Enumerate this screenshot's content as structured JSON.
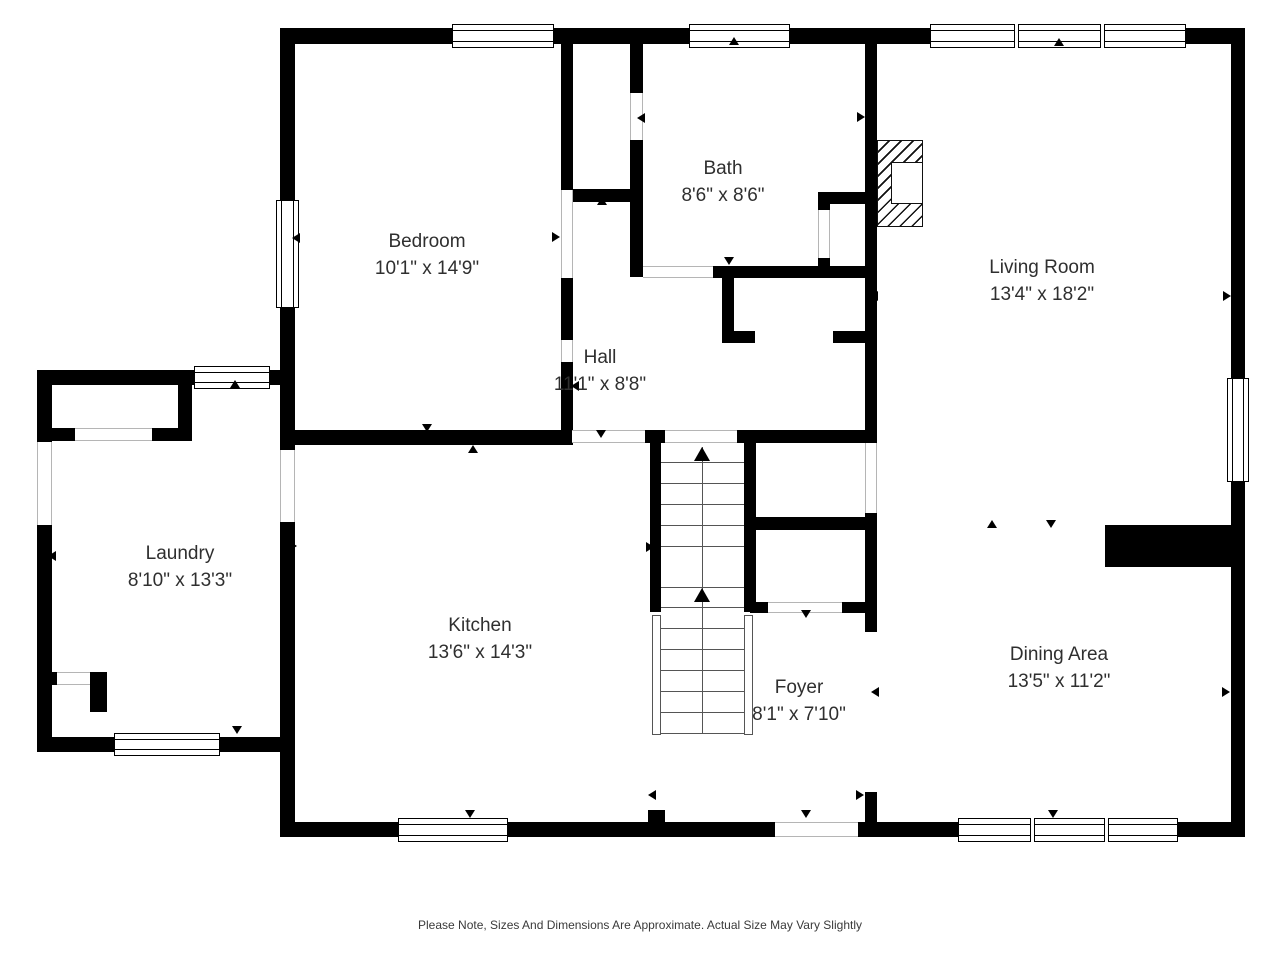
{
  "footer": {
    "note": "Please Note, Sizes And Dimensions Are Approximate. Actual Size May Vary Slightly"
  },
  "colors": {
    "wall": "#000000",
    "background": "#ffffff",
    "label_text": "#2f2f2f",
    "threshold_line": "#b5b5b5",
    "stair_line": "#555555"
  },
  "rooms": [
    {
      "name": "Bedroom",
      "dims": "10'1\" x 14'9\"",
      "cx": 427,
      "cy": 255
    },
    {
      "name": "Bath",
      "dims": "8'6\" x 8'6\"",
      "cx": 723,
      "cy": 182
    },
    {
      "name": "Living Room",
      "dims": "13'4\" x 18'2\"",
      "cx": 1042,
      "cy": 281
    },
    {
      "name": "Hall",
      "dims": "11'1\" x 8'8\"",
      "cx": 600,
      "cy": 371
    },
    {
      "name": "Laundry",
      "dims": "8'10\" x 13'3\"",
      "cx": 180,
      "cy": 567
    },
    {
      "name": "Kitchen",
      "dims": "13'6\" x 14'3\"",
      "cx": 480,
      "cy": 639
    },
    {
      "name": "Foyer",
      "dims": "8'1\" x 7'10\"",
      "cx": 799,
      "cy": 701
    },
    {
      "name": "Dining Area",
      "dims": "13'5\" x 11'2\"",
      "cx": 1059,
      "cy": 668
    }
  ],
  "geometry": {
    "walls": [
      [
        280,
        28,
        965,
        16
      ],
      [
        1231,
        28,
        14,
        350
      ],
      [
        1231,
        482,
        14,
        355
      ],
      [
        280,
        822,
        120,
        15
      ],
      [
        507,
        822,
        268,
        15
      ],
      [
        858,
        822,
        104,
        15
      ],
      [
        1177,
        822,
        68,
        15
      ],
      [
        280,
        42,
        15,
        160
      ],
      [
        280,
        307,
        15,
        143
      ],
      [
        280,
        522,
        15,
        300
      ],
      [
        37,
        370,
        15,
        72
      ],
      [
        37,
        525,
        15,
        227
      ],
      [
        37,
        370,
        160,
        15
      ],
      [
        268,
        370,
        19,
        15
      ],
      [
        37,
        737,
        77,
        15
      ],
      [
        220,
        737,
        75,
        15
      ],
      [
        178,
        385,
        14,
        55
      ],
      [
        37,
        428,
        38,
        13
      ],
      [
        152,
        428,
        40,
        13
      ],
      [
        37,
        672,
        20,
        13
      ],
      [
        90,
        672,
        17,
        13
      ],
      [
        90,
        672,
        17,
        40
      ],
      [
        280,
        430,
        292,
        15
      ],
      [
        561,
        42,
        12,
        148
      ],
      [
        561,
        278,
        12,
        62
      ],
      [
        561,
        362,
        12,
        83
      ],
      [
        561,
        189,
        82,
        13
      ],
      [
        630,
        42,
        13,
        51
      ],
      [
        630,
        140,
        13,
        137
      ],
      [
        713,
        266,
        162,
        12
      ],
      [
        818,
        192,
        12,
        18
      ],
      [
        818,
        258,
        12,
        14
      ],
      [
        818,
        192,
        53,
        12
      ],
      [
        722,
        278,
        12,
        65
      ],
      [
        722,
        331,
        33,
        12
      ],
      [
        833,
        331,
        38,
        12
      ],
      [
        865,
        42,
        12,
        401
      ],
      [
        865,
        513,
        12,
        119
      ],
      [
        865,
        792,
        12,
        45
      ],
      [
        645,
        430,
        20,
        13
      ],
      [
        737,
        430,
        140,
        13
      ],
      [
        650,
        443,
        11,
        169
      ],
      [
        744,
        443,
        12,
        169
      ],
      [
        750,
        517,
        121,
        13
      ],
      [
        750,
        602,
        18,
        11
      ],
      [
        842,
        602,
        29,
        11
      ],
      [
        1105,
        525,
        126,
        42
      ],
      [
        648,
        810,
        17,
        12
      ]
    ],
    "windows": [
      {
        "x": 452,
        "y": 24,
        "w": 102,
        "h": 24,
        "o": "h",
        "p": 1
      },
      {
        "x": 689,
        "y": 24,
        "w": 101,
        "h": 24,
        "o": "h",
        "p": 1
      },
      {
        "x": 930,
        "y": 24,
        "w": 256,
        "h": 24,
        "o": "h",
        "p": 3
      },
      {
        "x": 276,
        "y": 200,
        "w": 23,
        "h": 108,
        "o": "v",
        "p": 1
      },
      {
        "x": 1227,
        "y": 378,
        "w": 22,
        "h": 104,
        "o": "v",
        "p": 1
      },
      {
        "x": 398,
        "y": 818,
        "w": 110,
        "h": 24,
        "o": "h",
        "p": 1
      },
      {
        "x": 958,
        "y": 818,
        "w": 220,
        "h": 24,
        "o": "h",
        "p": 3
      },
      {
        "x": 194,
        "y": 366,
        "w": 76,
        "h": 23,
        "o": "h",
        "p": 1
      },
      {
        "x": 114,
        "y": 733,
        "w": 106,
        "h": 23,
        "o": "h",
        "p": 1
      }
    ],
    "openings": [
      {
        "x": 37,
        "y": 442,
        "w": 15,
        "h": 83,
        "o": "v"
      },
      {
        "x": 280,
        "y": 450,
        "w": 15,
        "h": 72,
        "o": "v"
      },
      {
        "x": 75,
        "y": 428,
        "w": 77,
        "h": 13,
        "o": "h"
      },
      {
        "x": 57,
        "y": 672,
        "w": 33,
        "h": 13,
        "o": "h"
      },
      {
        "x": 572,
        "y": 430,
        "w": 73,
        "h": 13,
        "o": "h"
      },
      {
        "x": 665,
        "y": 430,
        "w": 72,
        "h": 13,
        "o": "h"
      },
      {
        "x": 643,
        "y": 266,
        "w": 70,
        "h": 12,
        "o": "h"
      },
      {
        "x": 561,
        "y": 190,
        "w": 12,
        "h": 88,
        "o": "v"
      },
      {
        "x": 561,
        "y": 340,
        "w": 12,
        "h": 22,
        "o": "v"
      },
      {
        "x": 630,
        "y": 93,
        "w": 13,
        "h": 47,
        "o": "v"
      },
      {
        "x": 818,
        "y": 210,
        "w": 12,
        "h": 48,
        "o": "v"
      },
      {
        "x": 865,
        "y": 443,
        "w": 12,
        "h": 70,
        "o": "v"
      },
      {
        "x": 768,
        "y": 602,
        "w": 74,
        "h": 11,
        "o": "h"
      },
      {
        "x": 775,
        "y": 822,
        "w": 83,
        "h": 15,
        "o": "h"
      }
    ],
    "arrows": [
      {
        "x": 428,
        "y": 40,
        "d": "u"
      },
      {
        "x": 734,
        "y": 41,
        "d": "u"
      },
      {
        "x": 1059,
        "y": 42,
        "d": "u"
      },
      {
        "x": 235,
        "y": 384,
        "d": "u"
      },
      {
        "x": 473,
        "y": 449,
        "d": "u"
      },
      {
        "x": 602,
        "y": 201,
        "d": "u"
      },
      {
        "x": 992,
        "y": 524,
        "d": "u"
      },
      {
        "x": 427,
        "y": 428,
        "d": "d"
      },
      {
        "x": 601,
        "y": 434,
        "d": "d"
      },
      {
        "x": 729,
        "y": 261,
        "d": "d"
      },
      {
        "x": 806,
        "y": 614,
        "d": "d"
      },
      {
        "x": 1051,
        "y": 524,
        "d": "d"
      },
      {
        "x": 806,
        "y": 814,
        "d": "d"
      },
      {
        "x": 470,
        "y": 814,
        "d": "d"
      },
      {
        "x": 1053,
        "y": 814,
        "d": "d"
      },
      {
        "x": 237,
        "y": 730,
        "d": "d"
      },
      {
        "x": 296,
        "y": 238,
        "d": "l"
      },
      {
        "x": 52,
        "y": 556,
        "d": "l"
      },
      {
        "x": 284,
        "y": 554,
        "d": "l"
      },
      {
        "x": 874,
        "y": 296,
        "d": "l"
      },
      {
        "x": 875,
        "y": 692,
        "d": "l"
      },
      {
        "x": 652,
        "y": 795,
        "d": "l"
      },
      {
        "x": 575,
        "y": 386,
        "d": "l"
      },
      {
        "x": 641,
        "y": 118,
        "d": "l"
      },
      {
        "x": 293,
        "y": 546,
        "d": "r"
      },
      {
        "x": 556,
        "y": 237,
        "d": "r"
      },
      {
        "x": 861,
        "y": 117,
        "d": "r"
      },
      {
        "x": 650,
        "y": 547,
        "d": "r"
      },
      {
        "x": 1227,
        "y": 296,
        "d": "r"
      },
      {
        "x": 1226,
        "y": 692,
        "d": "r"
      },
      {
        "x": 860,
        "y": 795,
        "d": "r"
      }
    ],
    "stairs": {
      "x": 661,
      "w": 83,
      "treads": [
        462,
        483,
        504,
        525,
        546,
        587,
        607,
        628,
        649,
        670,
        691,
        712,
        733
      ],
      "center": {
        "x": 702,
        "y1": 447,
        "y2": 733
      },
      "rails": [
        [
          652,
          615,
          9,
          120
        ],
        [
          744,
          615,
          9,
          120
        ]
      ],
      "arrows": [
        {
          "x": 702,
          "y": 447
        },
        {
          "x": 702,
          "y": 588
        }
      ]
    },
    "fireplace": {
      "hatch": {
        "x": 877,
        "y": 140,
        "w": 46,
        "h": 87
      },
      "box": {
        "x": 891,
        "y": 162,
        "w": 32,
        "h": 42
      }
    }
  }
}
